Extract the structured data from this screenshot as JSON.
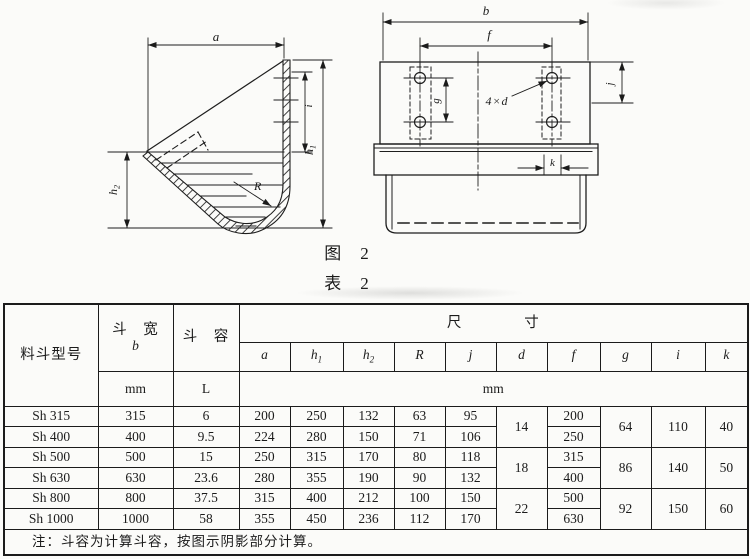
{
  "figure": {
    "caption_figure": "图　2",
    "caption_table": "表　2",
    "labels": {
      "a": "a",
      "h1t": "h",
      "h1s": "1",
      "h2t": "h",
      "h2s": "2",
      "i": "i",
      "R": "R",
      "b": "b",
      "f": "f",
      "g": "g",
      "j": "j",
      "k": "k",
      "holes": "4×d"
    }
  },
  "table": {
    "headers": {
      "model": "料斗型号",
      "width_title": "斗　宽",
      "width_symbol": "b",
      "width_unit": "mm",
      "volume_title": "斗　容",
      "volume_unit": "L",
      "dims_title": "尺　　　　寸",
      "dims_unit": "mm",
      "symbols": [
        {
          "t": "a",
          "s": ""
        },
        {
          "t": "h",
          "s": "1"
        },
        {
          "t": "h",
          "s": "2"
        },
        {
          "t": "R",
          "s": ""
        },
        {
          "t": "j",
          "s": ""
        },
        {
          "t": "d",
          "s": ""
        },
        {
          "t": "f",
          "s": ""
        },
        {
          "t": "g",
          "s": ""
        },
        {
          "t": "i",
          "s": ""
        },
        {
          "t": "k",
          "s": ""
        }
      ]
    },
    "rows": [
      {
        "model": "Sh 315",
        "b": "315",
        "vol": "6",
        "a": "200",
        "h1": "250",
        "h2": "132",
        "R": "63",
        "j": "95",
        "d": "14",
        "f": "200",
        "g": "64",
        "i": "110",
        "k": "40"
      },
      {
        "model": "Sh 400",
        "b": "400",
        "vol": "9.5",
        "a": "224",
        "h1": "280",
        "h2": "150",
        "R": "71",
        "j": "106",
        "f": "250"
      },
      {
        "model": "Sh 500",
        "b": "500",
        "vol": "15",
        "a": "250",
        "h1": "315",
        "h2": "170",
        "R": "80",
        "j": "118",
        "d": "18",
        "f": "315",
        "g": "86",
        "i": "140",
        "k": "50"
      },
      {
        "model": "Sh 630",
        "b": "630",
        "vol": "23.6",
        "a": "280",
        "h1": "355",
        "h2": "190",
        "R": "90",
        "j": "132",
        "f": "400"
      },
      {
        "model": "Sh 800",
        "b": "800",
        "vol": "37.5",
        "a": "315",
        "h1": "400",
        "h2": "212",
        "R": "100",
        "j": "150",
        "d": "22",
        "f": "500",
        "g": "92",
        "i": "150",
        "k": "60"
      },
      {
        "model": "Sh 1000",
        "b": "1000",
        "vol": "58",
        "a": "355",
        "h1": "450",
        "h2": "236",
        "R": "112",
        "j": "170",
        "f": "630"
      }
    ],
    "note": "注：斗容为计算斗容，按图示阴影部分计算。"
  }
}
